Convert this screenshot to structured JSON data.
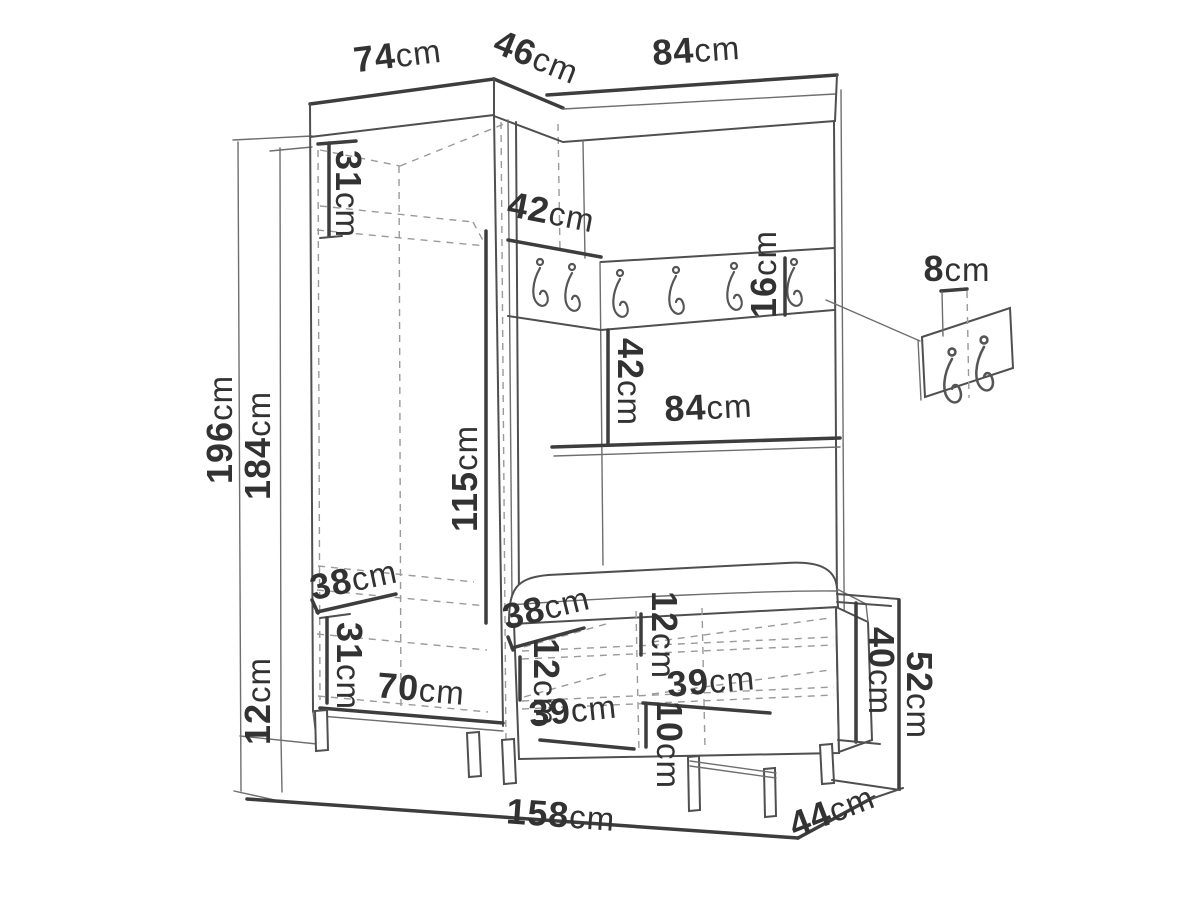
{
  "colors": {
    "background": "#ffffff",
    "line": "#4f4f4f",
    "thick_line": "#3d3d3d",
    "dashed_line": "#9a9a9a",
    "text": "#323232"
  },
  "dims": {
    "left_section_width": {
      "v": "74",
      "u": "cm"
    },
    "corner_section_width": {
      "v": "46",
      "u": "cm"
    },
    "right_section_width": {
      "v": "84",
      "u": "cm"
    },
    "top_shelf_height": {
      "v": "31",
      "u": "cm"
    },
    "corner_shelf_depth": {
      "v": "42",
      "u": "cm"
    },
    "hook_rail_height": {
      "v": "16",
      "u": "cm"
    },
    "hook_plate_width": {
      "v": "8",
      "u": "cm"
    },
    "rail_to_shelf_gap": {
      "v": "42",
      "u": "cm"
    },
    "inner_shelf_width": {
      "v": "84",
      "u": "cm"
    },
    "total_height": {
      "v": "196",
      "u": "cm"
    },
    "cabinet_height": {
      "v": "184",
      "u": "cm"
    },
    "hanging_space_height": {
      "v": "115",
      "u": "cm"
    },
    "shelf_depth": {
      "v": "38",
      "u": "cm"
    },
    "lower_compartment_height": {
      "v": "31",
      "u": "cm"
    },
    "plinth_height": {
      "v": "12",
      "u": "cm"
    },
    "cabinet_inner_width": {
      "v": "70",
      "u": "cm"
    },
    "bench_seat_depth": {
      "v": "38",
      "u": "cm"
    },
    "bench_top_compartment": {
      "v": "12",
      "u": "cm"
    },
    "bench_inner_compartment": {
      "v": "12",
      "u": "cm"
    },
    "bench_shelf_width_right": {
      "v": "39",
      "u": "cm"
    },
    "bench_shelf_width_left": {
      "v": "39",
      "u": "cm"
    },
    "bench_bottom_compartment": {
      "v": "10",
      "u": "cm"
    },
    "bench_cabinet_height": {
      "v": "40",
      "u": "cm"
    },
    "bench_total_height": {
      "v": "52",
      "u": "cm"
    },
    "total_width": {
      "v": "158",
      "u": "cm"
    },
    "total_depth": {
      "v": "44",
      "u": "cm"
    }
  }
}
